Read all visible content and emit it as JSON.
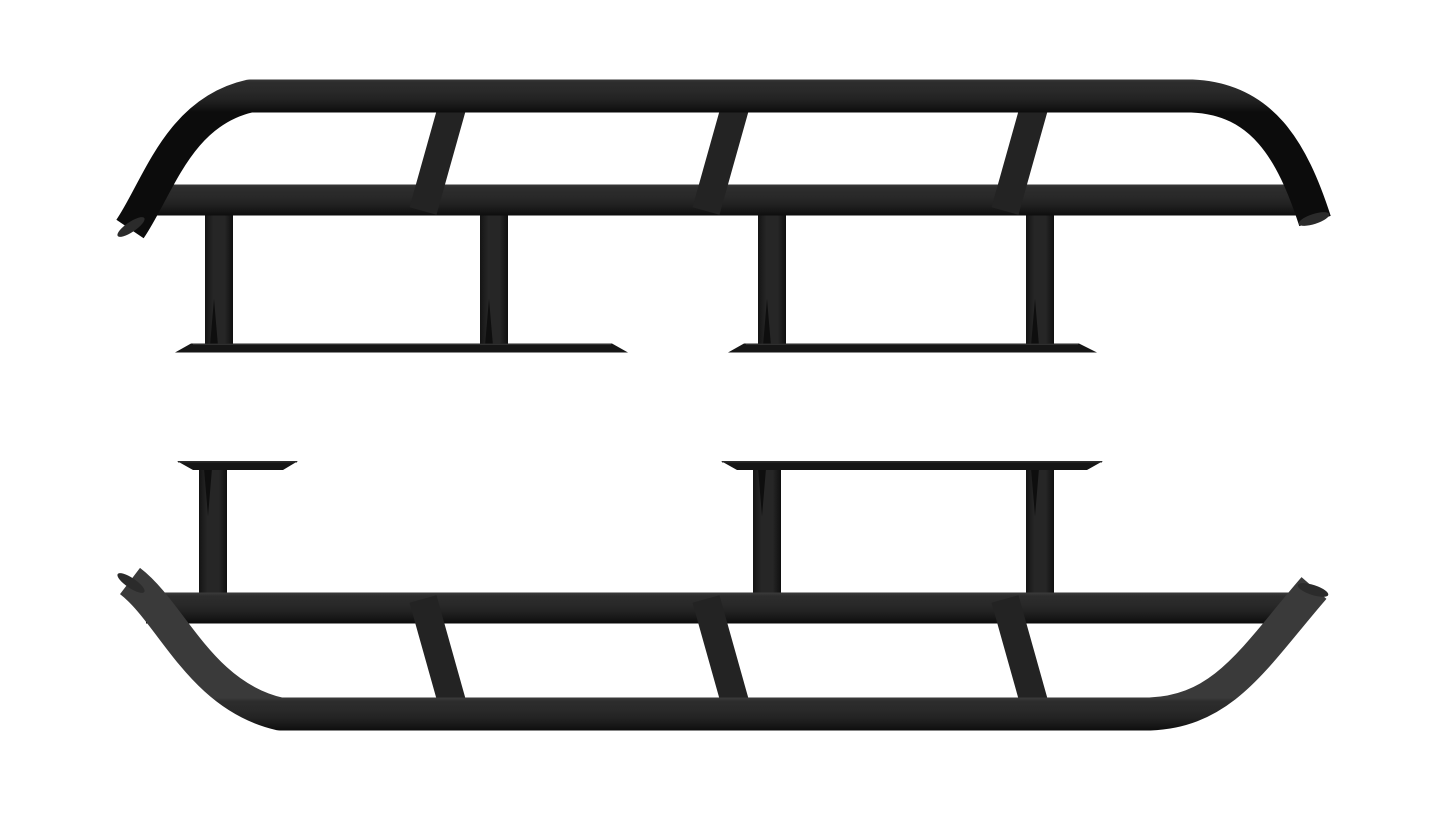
{
  "scene": {
    "type": "product-render",
    "subject": "Pair of black steel tubular rock-slider side steps with curved angle-cut tube ends, diagonal braces, vertical mounting legs and flat frame-mount plates on a white background",
    "background": "#ffffff",
    "canvas": {
      "width": 1445,
      "height": 813
    },
    "palette": {
      "tube_stops": [
        [
          0,
          "#3a3a3a"
        ],
        [
          0.1,
          "#2d2d2d"
        ],
        [
          0.38,
          "#292929"
        ],
        [
          0.62,
          "#222222"
        ],
        [
          0.85,
          "#161616"
        ],
        [
          1,
          "#0c0c0c"
        ]
      ],
      "leg_stops": [
        [
          0,
          "#141414"
        ],
        [
          0.3,
          "#262626"
        ],
        [
          0.7,
          "#262626"
        ],
        [
          1,
          "#0f0f0f"
        ]
      ],
      "diagonal": "#232323",
      "plate": "#161616",
      "plate_edge": "#2f2f2f",
      "gusset": "#0e0e0e",
      "tip_face": "#2b2b2b"
    },
    "tube_sizes": {
      "outer": 33,
      "main": 31,
      "diagonal": 28,
      "leg": 28
    },
    "sliders": [
      {
        "name": "rock-slider-top",
        "outer_path": "M 130 229 C 158 188 178 112 250 96 L 1192 96 C 1262 99 1292 150 1315 221",
        "outer_gradient_y": [
          79,
          112
        ],
        "main_tube": {
          "x1": 146,
          "x2": 1302,
          "y": 200
        },
        "main_gradient_y": [
          184,
          216
        ],
        "diagonals": [
          {
            "x1": 455,
            "y1": 97,
            "x2": 423,
            "y2": 211
          },
          {
            "x1": 738,
            "y1": 97,
            "x2": 706,
            "y2": 211
          },
          {
            "x1": 1037,
            "y1": 97,
            "x2": 1005,
            "y2": 211
          }
        ],
        "legs_x": [
          219,
          494,
          772,
          1040
        ],
        "legs_y": [
          204,
          349
        ],
        "gussets": [
          "210,346 214,299 218,346",
          "485,346 489,299 493,346",
          "763,346 767,299 771,346",
          "1031,346 1035,299 1039,346"
        ],
        "plates": [
          {
            "points": "175,352.5 191,343.5 612,343.5 628,352.5",
            "edge": [
              193,
              344.3,
              611,
              344.3
            ]
          },
          {
            "points": "728,352.5 744,343.5 1079,343.5 1097,352.5",
            "edge": [
              746,
              344.3,
              1078,
              344.3
            ]
          }
        ],
        "tips": [
          {
            "cx": 131,
            "cy": 227,
            "rotate": -34
          },
          {
            "cx": 1314,
            "cy": 219,
            "rotate": -18
          }
        ]
      },
      {
        "name": "rock-slider-bottom",
        "outer_path": "M 130 581 C 172 613 200 696 280 714 L 1150 714 C 1225 711 1255 656 1314 588",
        "outer_gradient_y": [
          698,
          731
        ],
        "main_tube": {
          "x1": 146,
          "x2": 1295,
          "y": 608
        },
        "main_gradient_y": [
          593,
          623
        ],
        "diagonals": [
          {
            "x1": 423,
            "y1": 599,
            "x2": 455,
            "y2": 713
          },
          {
            "x1": 706,
            "y1": 599,
            "x2": 738,
            "y2": 713
          },
          {
            "x1": 1005,
            "y1": 599,
            "x2": 1037,
            "y2": 713
          }
        ],
        "legs_x": [
          213,
          767,
          1040
        ],
        "legs_y": [
          464,
          612
        ],
        "gussets": [
          "204,468 208,516 212,468",
          "758,468 762,516 766,468",
          "1031,468 1035,516 1039,468"
        ],
        "plates": [
          {
            "points": "177,461 298,461 283,470 193,470",
            "edge": [
              178,
              461.8,
              297,
              461.8
            ]
          },
          {
            "points": "721,461 1103,461 1087,470 737,470",
            "edge": [
              722,
              461.8,
              1102,
              461.8
            ]
          }
        ],
        "tips": [
          {
            "cx": 131,
            "cy": 583,
            "rotate": 34
          },
          {
            "cx": 1313,
            "cy": 590,
            "rotate": 18
          }
        ]
      }
    ]
  }
}
